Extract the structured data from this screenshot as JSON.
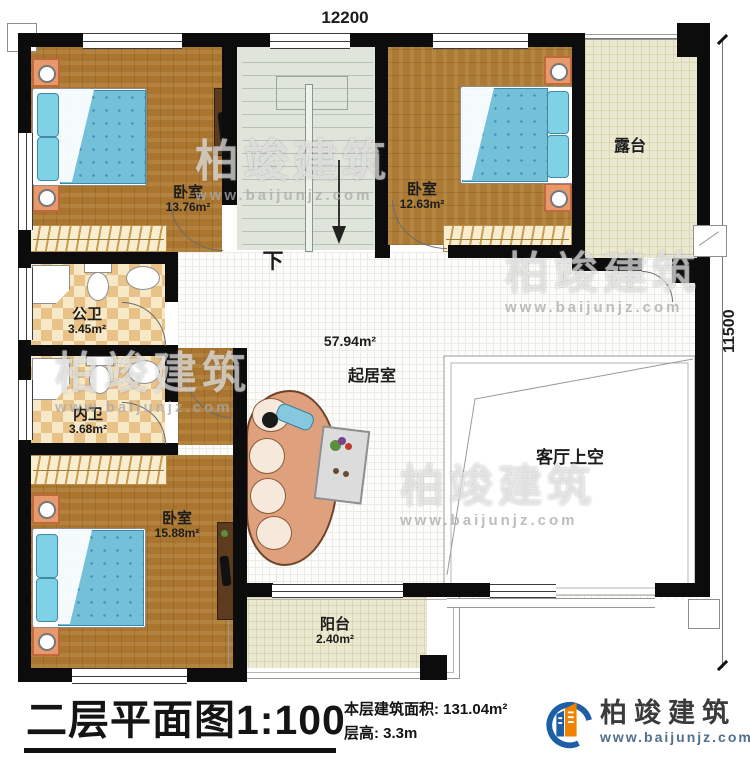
{
  "dimensions": {
    "width_label": "12200",
    "height_label": "11500"
  },
  "rooms": {
    "bedroom_tl": {
      "name": "卧室",
      "area": "13.76m²"
    },
    "bedroom_tr": {
      "name": "卧室",
      "area": "12.63m²"
    },
    "bedroom_bl": {
      "name": "卧室",
      "area": "15.88m²"
    },
    "bath_public": {
      "name": "公卫",
      "area": "3.45m²"
    },
    "bath_private": {
      "name": "内卫",
      "area": "3.68m²"
    },
    "terrace": {
      "name": "露台"
    },
    "balcony": {
      "name": "阳台",
      "area": "2.40m²"
    },
    "living": {
      "name": "起居室",
      "area": "57.94m²"
    },
    "void": {
      "name": "客厅上空"
    },
    "stairs": {
      "down_label": "下"
    }
  },
  "title_block": {
    "title": "二层平面图",
    "scale": "1:100",
    "floor_area_label": "本层建筑面积: 131.04m²",
    "floor_height_label": "层高: 3.3m"
  },
  "logo": {
    "company": "柏竣建筑",
    "website": "www.baijunjz.com"
  },
  "watermark": {
    "company": "柏竣建筑",
    "website": "www.baijunjz.com"
  },
  "colors": {
    "wall": "#0c0c0c",
    "wood": "#a9752f",
    "mattress": "#74c0d8",
    "terrace_floor": "#ece9d2",
    "logo_blue": "#1d5fa7",
    "logo_orange": "#ef8200"
  }
}
